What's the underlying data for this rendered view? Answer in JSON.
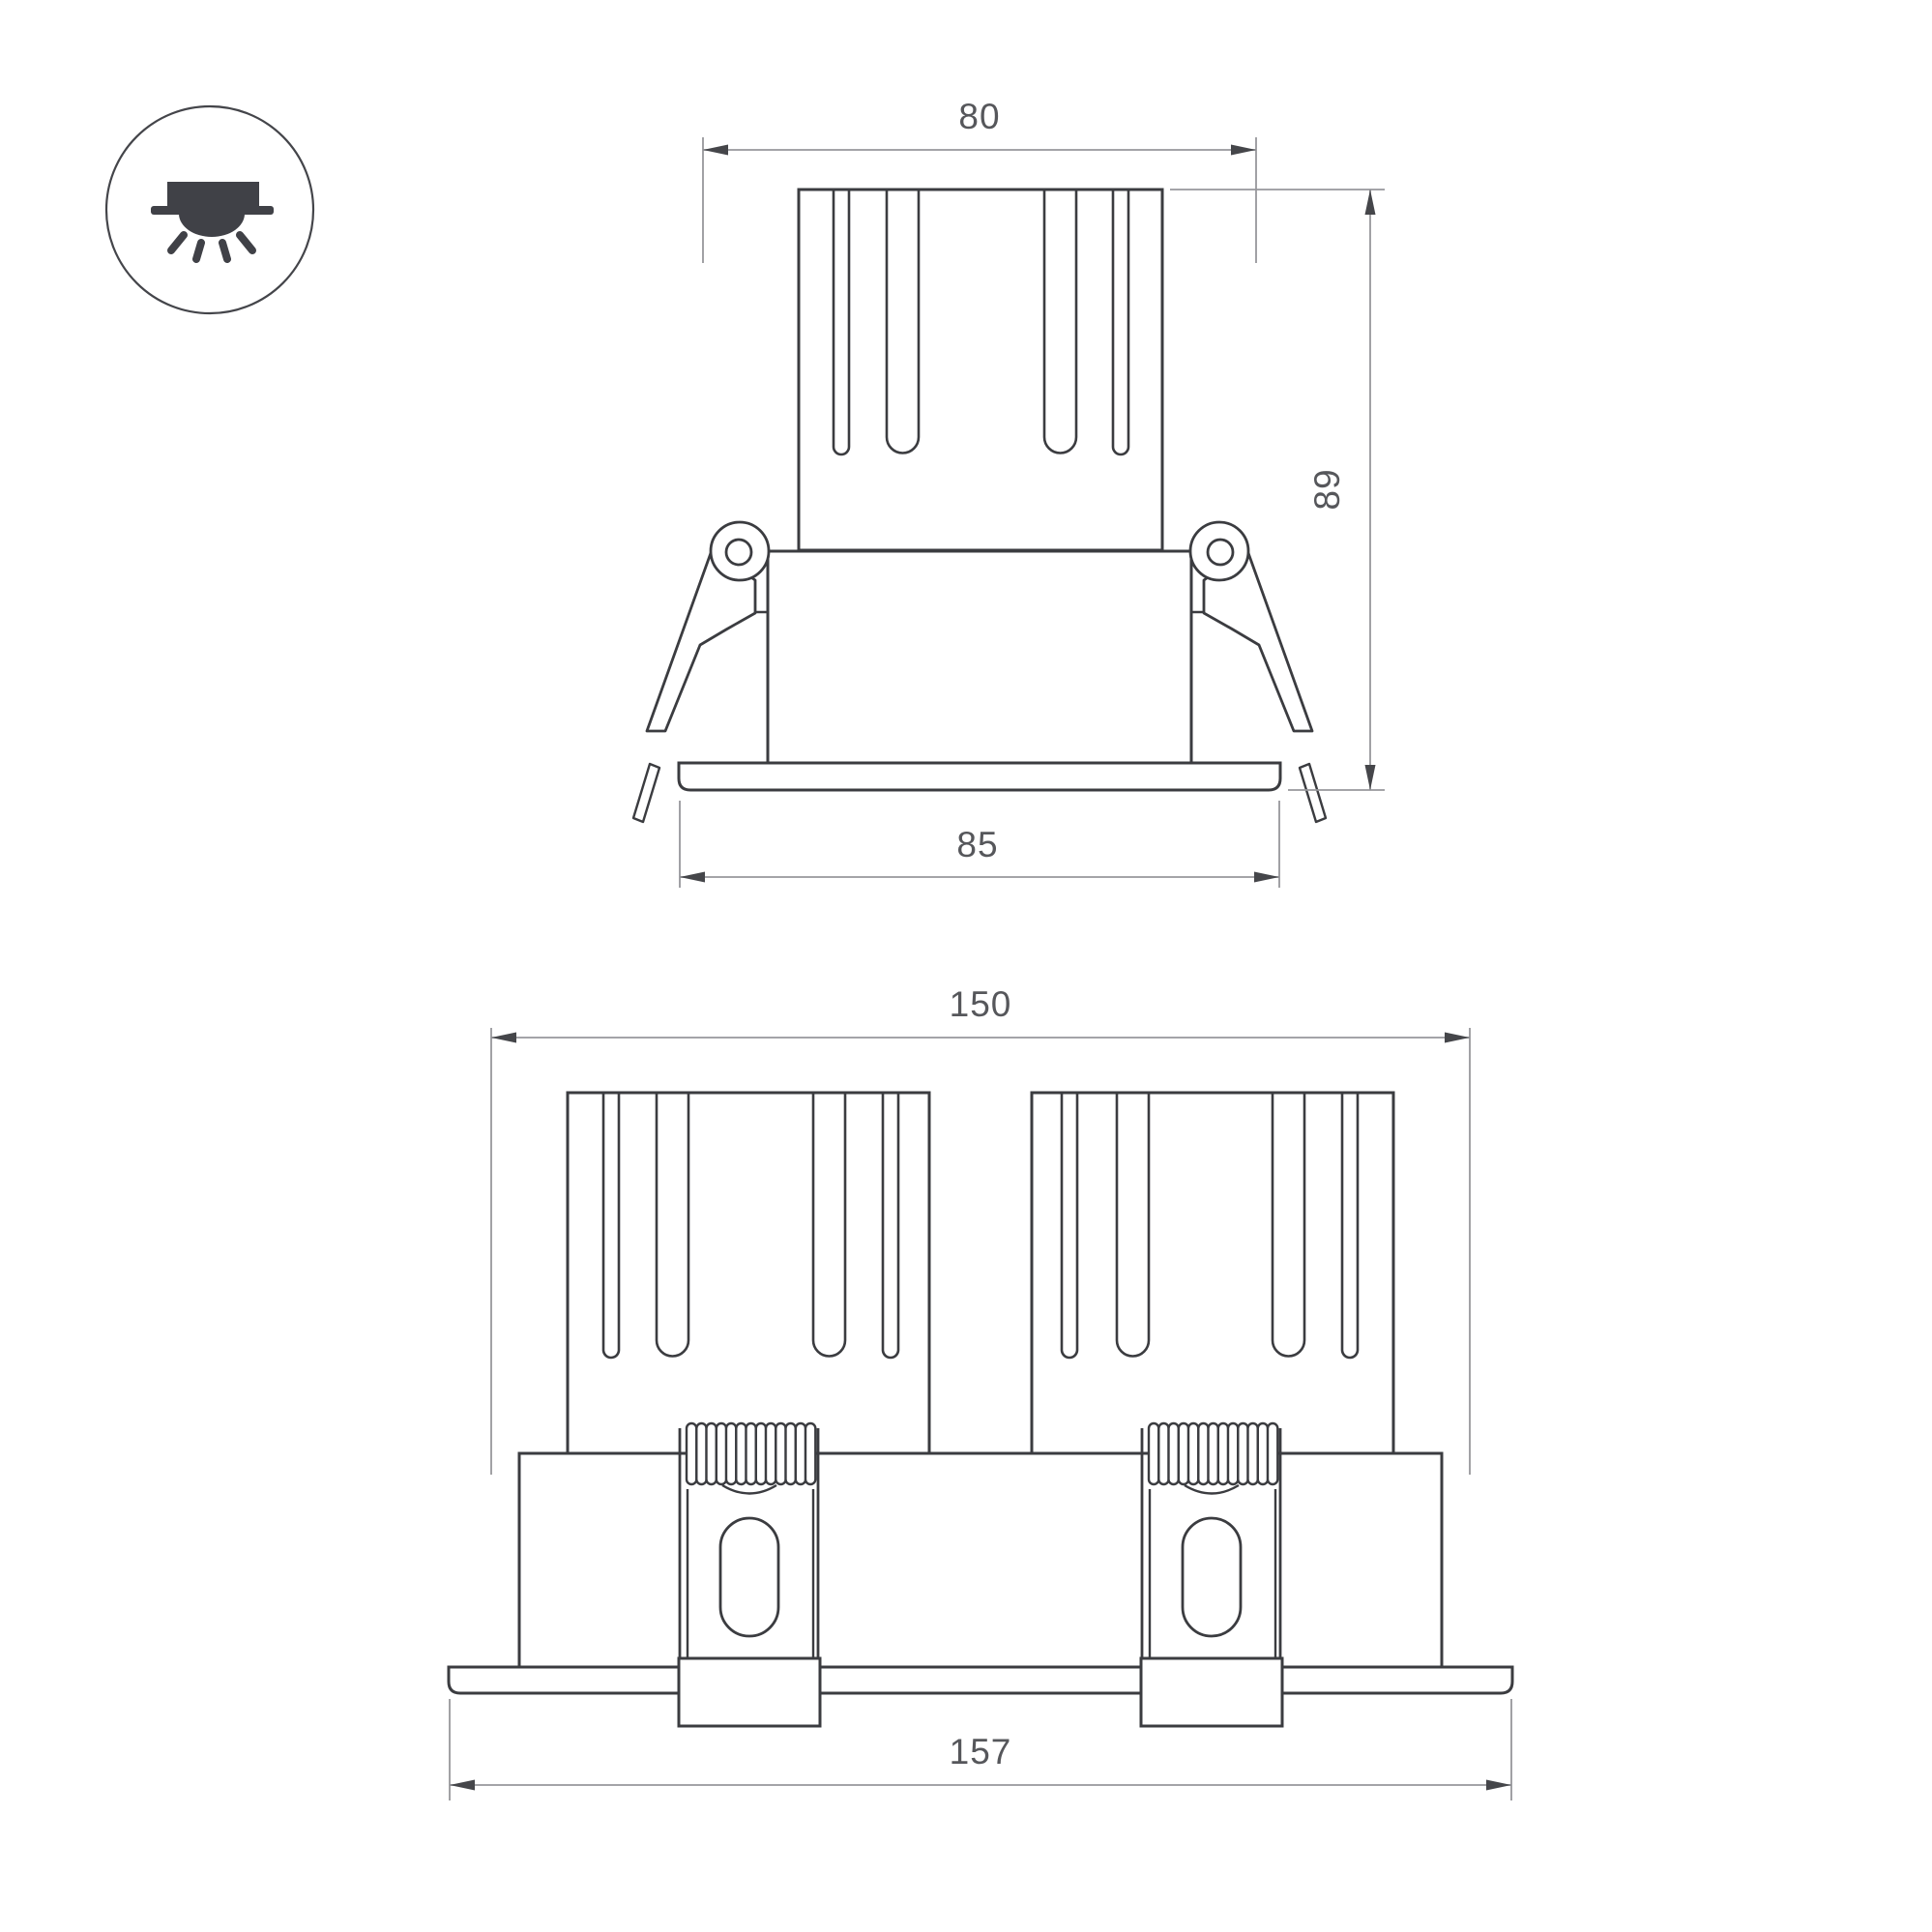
{
  "page": {
    "background": "#ffffff"
  },
  "palette": {
    "object_line": "#3b3c40",
    "dimension_line": "#97979b",
    "arrow_fill": "#45464a",
    "label_text": "#56575b",
    "icon_ink": "#404147"
  },
  "icon_badge": {
    "icon": "recessed-downlight-icon"
  },
  "views": {
    "single": {
      "name": "front-view-single-module",
      "dims": {
        "top_width": "80",
        "height": "89",
        "flange_width": "85"
      }
    },
    "double": {
      "name": "front-view-twin-module",
      "dims": {
        "body_width": "150",
        "flange_width": "157"
      }
    }
  }
}
